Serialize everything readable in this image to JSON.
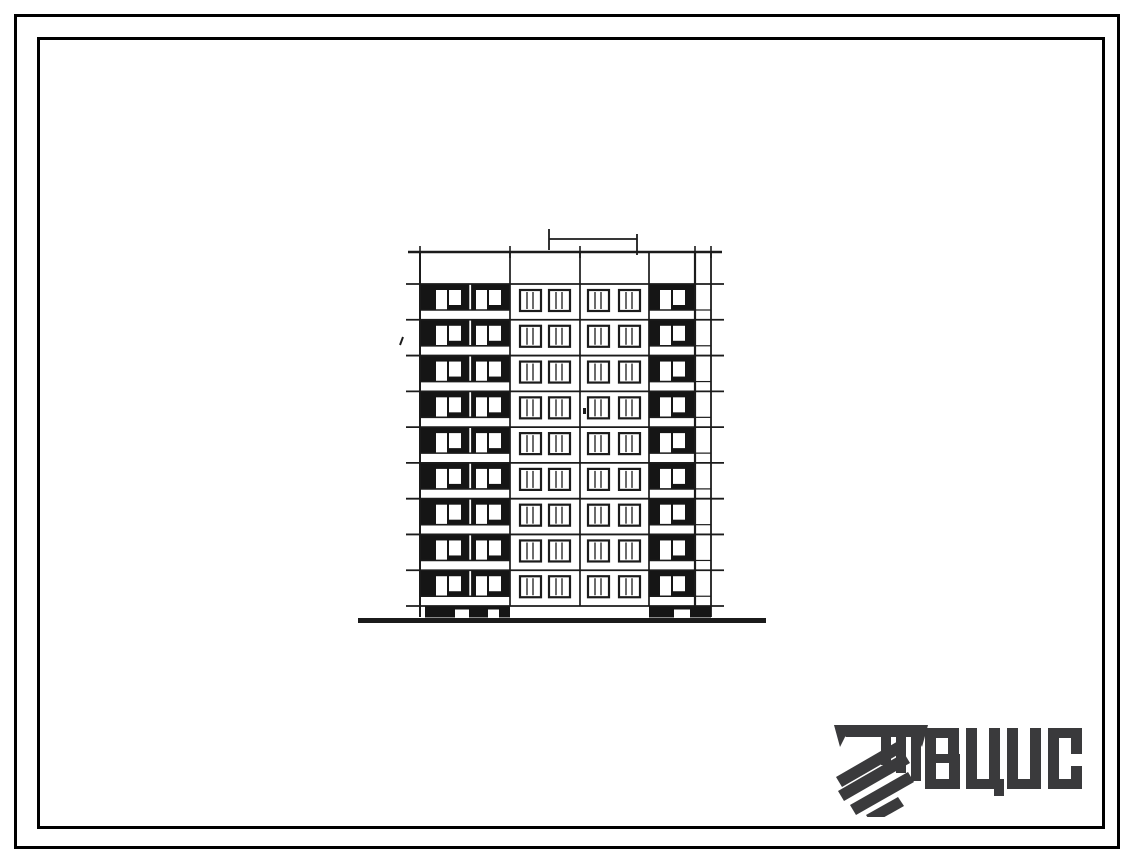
{
  "page": {
    "background": "#ffffff"
  },
  "frame": {
    "outer_color": "#000000",
    "inner_color": "#000000"
  },
  "elevation": {
    "kind": "nine-storey panel building facade elevation drawing",
    "floors": 9,
    "center_windows_per_floor": 4,
    "left_balcony_units_per_floor": 2,
    "right_balcony_units_per_floor": 1,
    "ink": "#1b1b1b",
    "panel_fill": "#151515",
    "paper": "#ffffff"
  },
  "logo": {
    "text": "ВЦИС",
    "letters": [
      "В",
      "Ц",
      "И",
      "С"
    ],
    "color": "#3a3a3c",
    "icon": "hatched-beam-logo-icon"
  }
}
